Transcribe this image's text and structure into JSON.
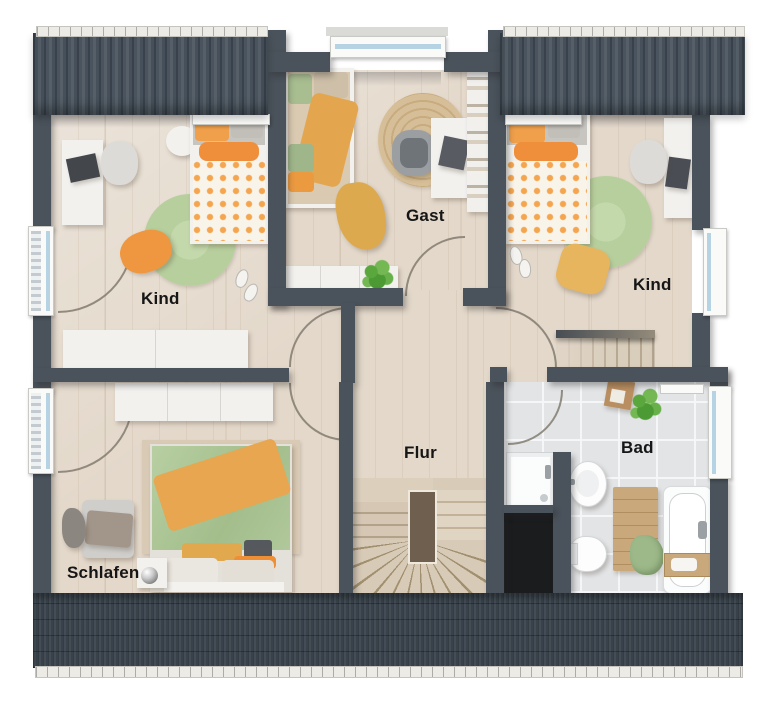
{
  "rooms": [
    {
      "id": "kind_top_left",
      "label": "Kind"
    },
    {
      "id": "gast",
      "label": "Gast"
    },
    {
      "id": "kind_top_right",
      "label": "Kind"
    },
    {
      "id": "flur",
      "label": "Flur"
    },
    {
      "id": "bad",
      "label": "Bad"
    },
    {
      "id": "schlafen",
      "label": "Schlafen"
    }
  ],
  "palette": {
    "wall": "#4a525b",
    "roof": "#46505a",
    "roof_groove": "#39424c",
    "roof_bottom": "#3d454e",
    "gutter": "#edebe5",
    "wood": "#e3d8ca",
    "tile": "#e2e4e6",
    "grout": "#f4f6f7",
    "rug_green": "#b7cf9d",
    "rug_jute": "#d6bf98",
    "rug_beige": "#d8cab4",
    "accent_orange": "#ee9740",
    "accent_mustard": "#e3a84e",
    "accent_sage": "#a9c292",
    "furniture_white": "#f2f1ee",
    "void": "#1a1c1e",
    "glass": "#b6d3e3",
    "label": "#161616"
  }
}
